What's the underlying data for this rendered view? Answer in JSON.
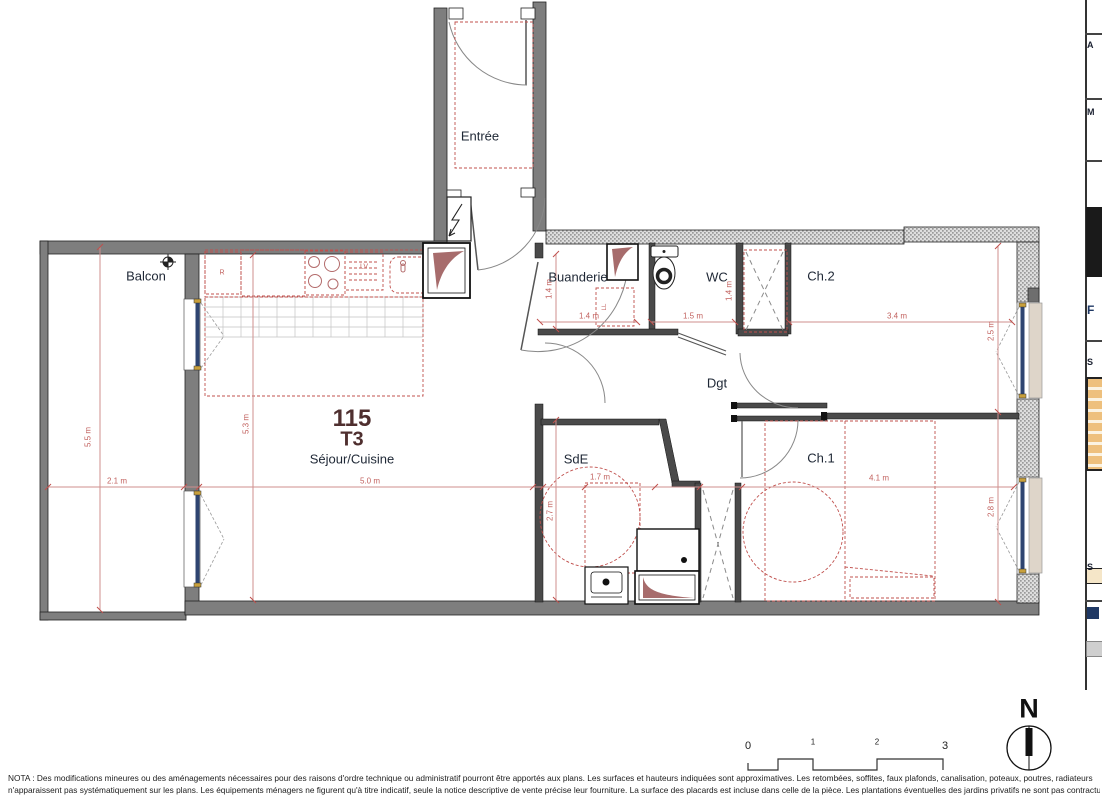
{
  "plan": {
    "unit": {
      "number": "115",
      "type": "T3"
    },
    "rooms": {
      "entree": "Entrée",
      "balcon": "Balcon",
      "sejour_cuisine": "Séjour/Cuisine",
      "buanderie": "Buanderie",
      "wc": "WC",
      "ch2": "Ch.2",
      "dgt": "Dgt",
      "sde": "SdE",
      "ch1": "Ch.1"
    },
    "appliances": {
      "fridge": "R",
      "dishwasher": "LV",
      "washing_machine": "LL"
    },
    "dimensions": {
      "balcon_width": "2.1 m",
      "balcon_depth": "5.5 m",
      "sejour_width": "5.0 m",
      "sejour_depth": "5.3 m",
      "buanderie_width": "1.4 m",
      "buanderie_depth": "1.4 m",
      "wc_width": "1.5 m",
      "wc_depth": "1.4 m",
      "ch2_width": "3.4 m",
      "ch2_depth": "2.5 m",
      "sde_width": "1.7 m",
      "sde_depth": "2.7 m",
      "ch1_width": "4.1 m",
      "ch1_depth": "2.8 m"
    },
    "scale_bar": {
      "ticks": [
        "0",
        "1",
        "2",
        "3"
      ]
    },
    "north": {
      "label": "N"
    },
    "colors": {
      "wall": "#7e7e7e",
      "dimension_line": "#cf8f8d",
      "zone_dashed": "#c0504d",
      "unit_text": "#4f2f2f",
      "room_text": "#1e2735",
      "window": "#2e4470",
      "duct": "#a76c6c"
    }
  },
  "side_panel": {
    "fragments": [
      {
        "text": "A"
      },
      {
        "text": "M"
      },
      {
        "text": "F"
      },
      {
        "text": "S"
      },
      {
        "text": "S"
      }
    ]
  },
  "nota": {
    "line1": "NOTA : Des modifications mineures ou des aménagements nécessaires pour des raisons d'ordre technique ou administratif pourront être apportés aux plans. Les surfaces et hauteurs indiquées sont approximatives. Les retombées, soffites, faux plafonds, canalisation, poteaux, poutres, radiateurs",
    "line2": "n'apparaissent pas systématiquement sur les plans.  Les équipements ménagers ne figurent qu'à titre indicatif, seule la notice descriptive de vente précise leur fourniture. La surface des placards est incluse dans celle de la pièce. Les plantations éventuelles des jardins privatifs ne sont pas contractuelles."
  }
}
